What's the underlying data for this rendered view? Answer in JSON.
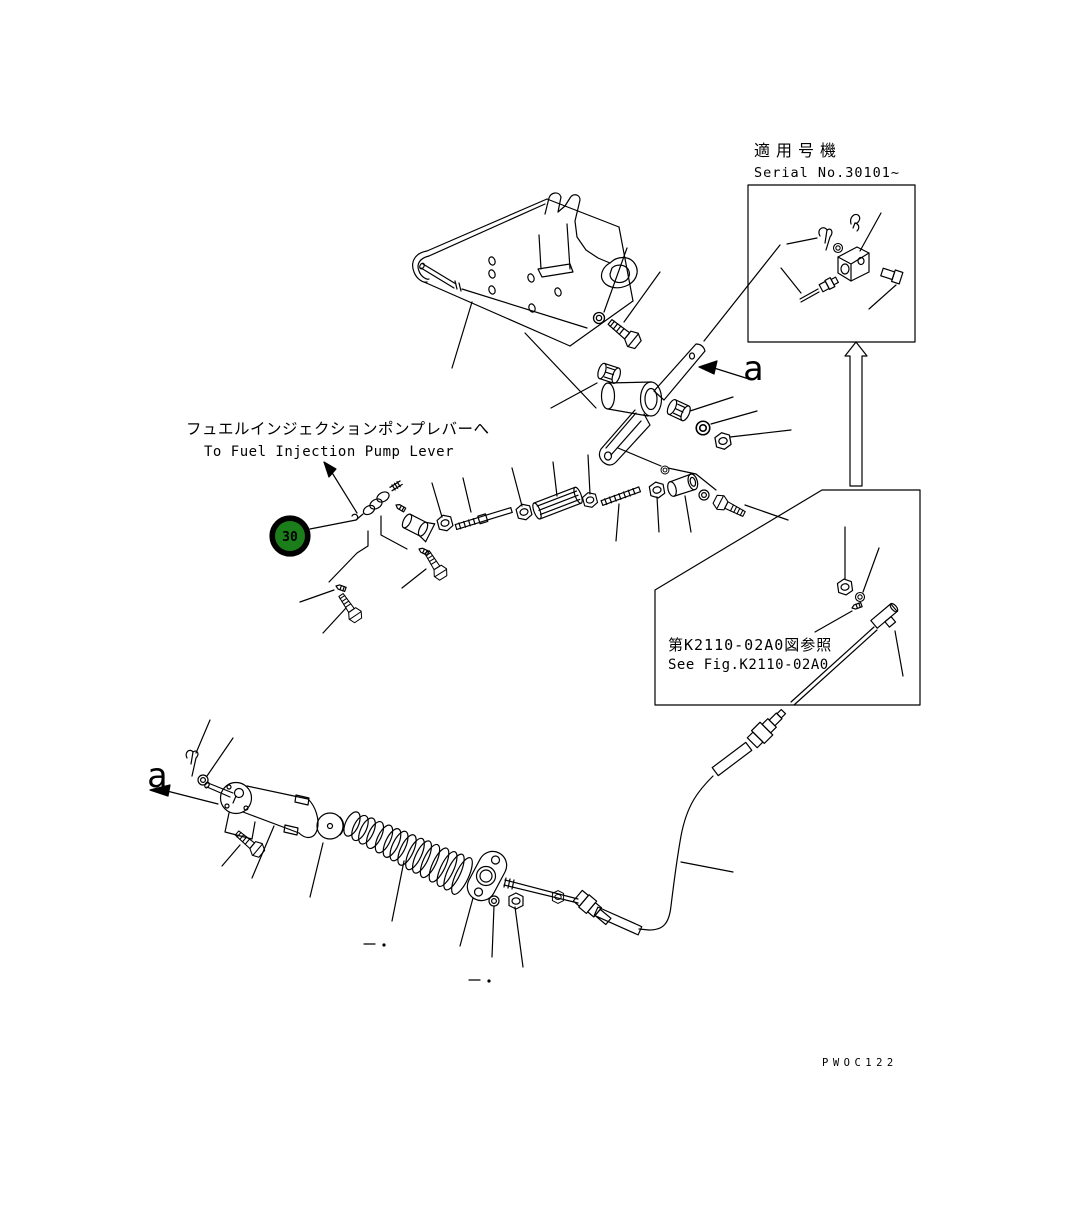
{
  "page": {
    "width": 1071,
    "height": 1218,
    "background": "#ffffff"
  },
  "colors": {
    "line": "#000000",
    "callout_fill": "#1b7e1b",
    "callout_ring": "#000000",
    "callout_text": "#ffffff"
  },
  "notes": {
    "fuel_pump_jp": "フュエルインジェクションポンプレバーへ",
    "fuel_pump_en": "To Fuel Injection Pump Lever"
  },
  "serial_box": {
    "title_jp": "適用号機",
    "title_en": "Serial No.30101~"
  },
  "see_fig_box": {
    "ref_jp": "第K2110-02A0図参照",
    "ref_en": "See Fig.K2110-02A0"
  },
  "callouts": {
    "part_30": "30",
    "view_a_top": "a",
    "view_a_bottom": "a"
  },
  "drawing_code": "PWOC122"
}
